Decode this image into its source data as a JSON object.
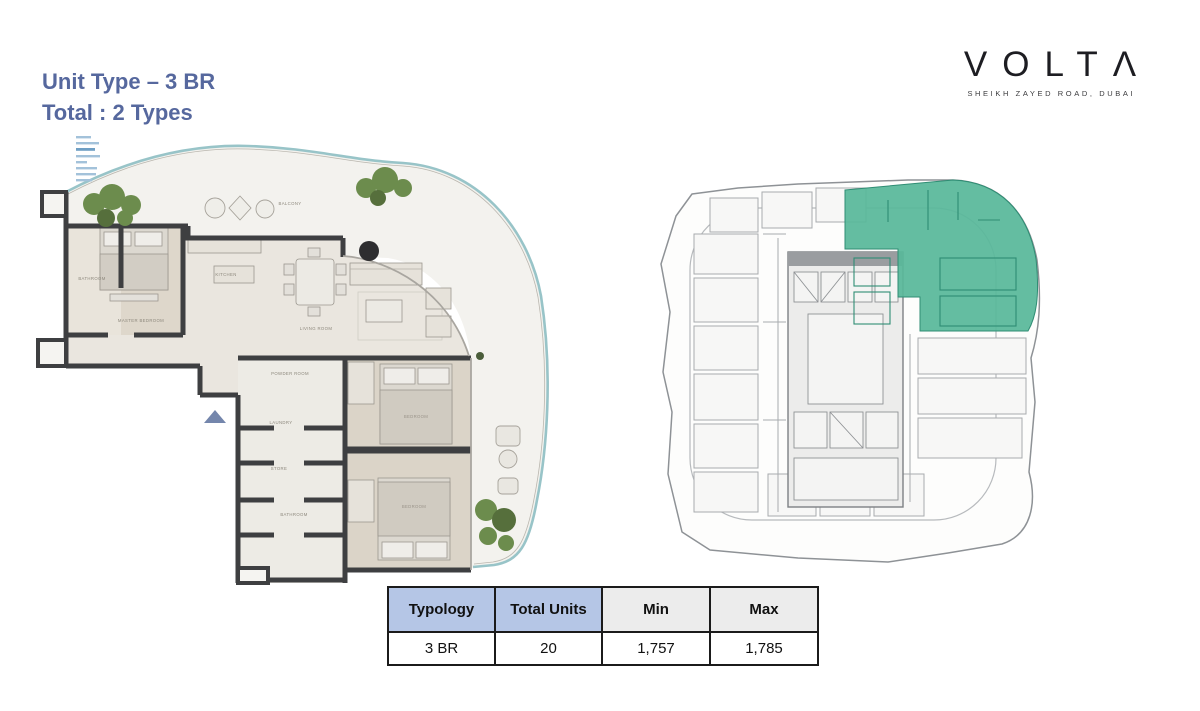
{
  "header": {
    "title_line1": "Unit Type – 3 BR",
    "title_line2": "Total : 2 Types"
  },
  "logo": {
    "text": "VOLTΛ",
    "tagline": "SHEIKH ZAYED ROAD, DUBAI"
  },
  "unit_plan": {
    "labels": {
      "balcony": "BALCONY",
      "bathroom": "BATHROOM",
      "master_bedroom": "MASTER BEDROOM",
      "kitchen": "KITCHEN",
      "living_room": "LIVING ROOM",
      "powder_room": "POWDER ROOM",
      "laundry": "LAUNDRY",
      "store": "STORE",
      "bathroom2": "BATHROOM",
      "bedroom2": "BEDROOM",
      "bedroom3": "BEDROOM"
    }
  },
  "key_plan": {
    "highlight_color": "#58b89a"
  },
  "table": {
    "headers": [
      "Typology",
      "Total Units",
      "Min",
      "Max"
    ],
    "row": [
      "3 BR",
      "20",
      "1,757",
      "1,785"
    ]
  }
}
